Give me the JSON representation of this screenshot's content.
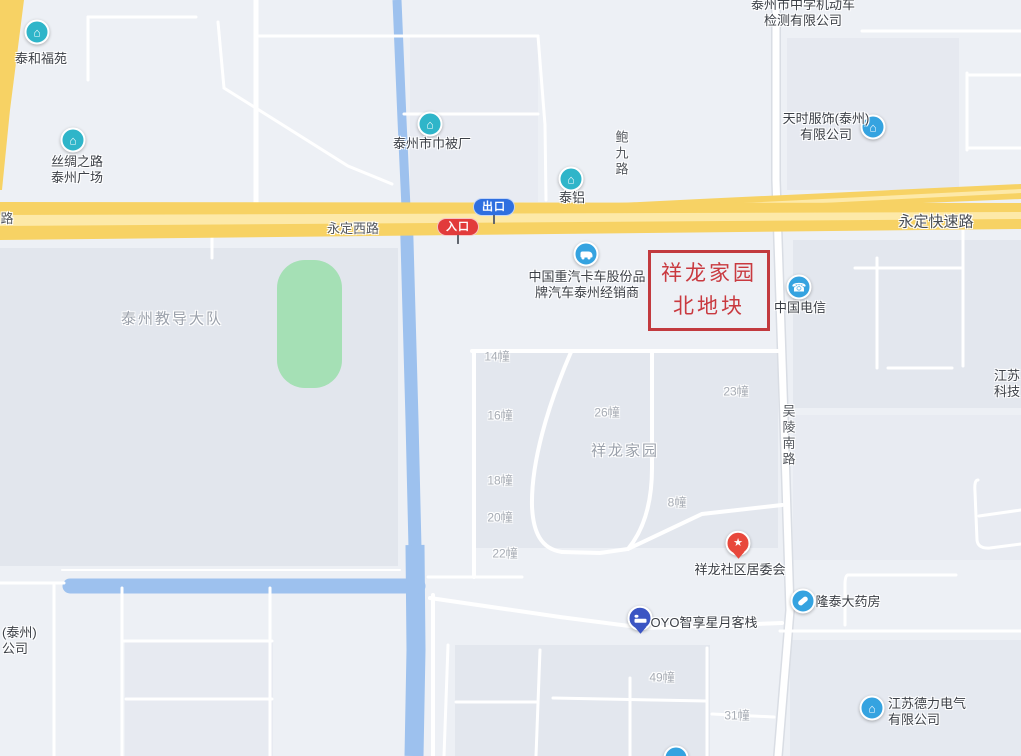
{
  "highlight_box": {
    "text": "祥龙家园\n北地块"
  },
  "badges": {
    "exit": "出口",
    "entrance": "入口"
  },
  "labels": [
    {
      "text": "泰和福苑"
    },
    {
      "text": "丝绸之路\n泰州广场"
    },
    {
      "text": "泰州市巾被厂"
    },
    {
      "text": "泰铝"
    },
    {
      "text": "鲍九路"
    },
    {
      "text": "泰州市中学机动车\n检测有限公司"
    },
    {
      "text": "天时服饰(泰州)\n有限公司"
    },
    {
      "text": "永定西路"
    },
    {
      "text": "路"
    },
    {
      "text": "永定快速路"
    },
    {
      "text": "中国重汽卡车股份品\n牌汽车泰州经销商"
    },
    {
      "text": "中国电信"
    },
    {
      "text": "泰州教导大队"
    },
    {
      "text": "祥龙家园"
    },
    {
      "text": "吴陵南路"
    },
    {
      "text": "江苏\n科技"
    },
    {
      "text": "14幢"
    },
    {
      "text": "16幢"
    },
    {
      "text": "26幢"
    },
    {
      "text": "23幢"
    },
    {
      "text": "18幢"
    },
    {
      "text": "8幢"
    },
    {
      "text": "20幢"
    },
    {
      "text": "22幢"
    },
    {
      "text": "祥龙社区居委会"
    },
    {
      "text": "隆泰大药房"
    },
    {
      "text": "OYO智享星月客栈"
    },
    {
      "text": "49幢"
    },
    {
      "text": "31幢"
    },
    {
      "text": "江苏德力电气\n有限公司"
    },
    {
      "text": "(泰州)\n公司"
    }
  ],
  "glyphs": {
    "building": "⌂",
    "telecom": "☎",
    "star": "★"
  },
  "colors": {
    "background": "#edf0f5",
    "block_fill": "#e2e6ed",
    "highway_yellow": "#f7d264",
    "highway_stripe": "#fde9a8",
    "river_blue": "#9dc1ee",
    "green_area": "#a5e0b5",
    "highlight_red": "#c23a3e",
    "poi_teal": "#2fb5c9",
    "poi_blue": "#35a3e0",
    "pin_red": "#e8483c",
    "pin_indigo": "#3b55c3",
    "badge_exit_blue": "#2f6fe0",
    "badge_entrance_red": "#e23b3b"
  }
}
